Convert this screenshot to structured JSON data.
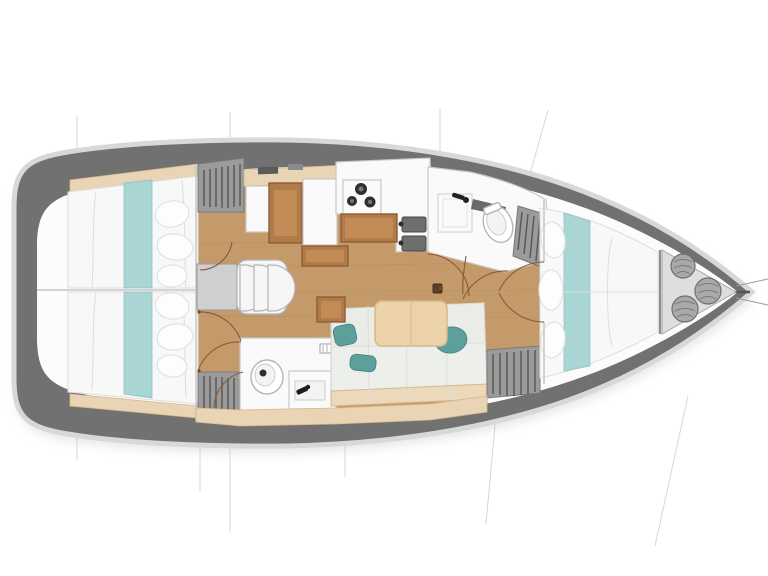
{
  "diagram": {
    "type": "yacht-floor-plan",
    "view": "top-down interior deck plan",
    "orientation": {
      "bow": "right",
      "stern": "left"
    },
    "rooms": [
      {
        "id": "aft-cabin-top",
        "name": "aft double cabin (upper)",
        "features": [
          "double-berth",
          "teal-runner",
          "pillows",
          "hanging-locker"
        ]
      },
      {
        "id": "aft-cabin-bottom",
        "name": "aft double cabin (lower)",
        "features": [
          "double-berth",
          "teal-runner",
          "pillows",
          "hanging-locker"
        ]
      },
      {
        "id": "companionway",
        "name": "companionway entry",
        "features": [
          "landing-platform",
          "curved-steps"
        ]
      },
      {
        "id": "nav-station",
        "name": "navigation station",
        "features": [
          "chart-table",
          "seat",
          "cabinet"
        ]
      },
      {
        "id": "galley",
        "name": "galley",
        "features": [
          "three-burner-stove",
          "double-sink",
          "counter",
          "storage-cabinet"
        ]
      },
      {
        "id": "head-forward",
        "name": "forward head",
        "features": [
          "toilet",
          "vanity-sink",
          "shower-pan",
          "swing-door"
        ]
      },
      {
        "id": "head-aft",
        "name": "aft head",
        "features": [
          "toilet",
          "vanity-sink",
          "swing-door"
        ]
      },
      {
        "id": "salon",
        "name": "salon",
        "features": [
          "l-shaped-sofa",
          "accent-cushions",
          "dining-table",
          "mast-post",
          "side-cabinet"
        ]
      },
      {
        "id": "forward-cabin",
        "name": "forward v-berth cabin",
        "features": [
          "v-berth",
          "teal-runner",
          "pillows",
          "hanging-lockers",
          "double-doors"
        ]
      },
      {
        "id": "bow-locker",
        "name": "bow sail locker",
        "features": [
          "fenders"
        ]
      }
    ],
    "counts": {
      "aft_cabins": 2,
      "heads": 2,
      "companionway_steps": 3,
      "stove_burners": 3,
      "galley_sinks": 2,
      "salon_accent_cushions": 3,
      "bow_fenders": 3,
      "hanging_lockers": 4
    }
  },
  "palette": {
    "hull-deck": "#717171",
    "hull-rim": "#d8d8d8",
    "interior": "#fcfcfc",
    "wood": "#c59a6b",
    "wood-edge": "#a97f52",
    "beige": "#e9d4b5",
    "teal": "#a9d6d4",
    "teal-dark": "#5d9f9b",
    "mattress": "#f8f8f8",
    "mattress-line": "#dedede",
    "locker-gray": "#9b9b9b",
    "locker-dark": "#4f4f4f",
    "furn-white": "#fafafa",
    "furn-stroke": "#c8c8c8",
    "desk-brown": "#b07a4b",
    "desk-edge": "#8f5e33",
    "table-wood": "#ecd3a9",
    "table-edge": "#d8b88a",
    "sofa": "#edefeb",
    "sofa-edge": "#d2d2ca",
    "sofa-base": "#ecd8ba",
    "steel": "#6e6e6e",
    "dark": "#2e2e2e",
    "arc": "#8a5a31",
    "section-line": "#9a9a9a",
    "fender": "#a9a9a9",
    "fender-dark": "#6e6e6e"
  }
}
